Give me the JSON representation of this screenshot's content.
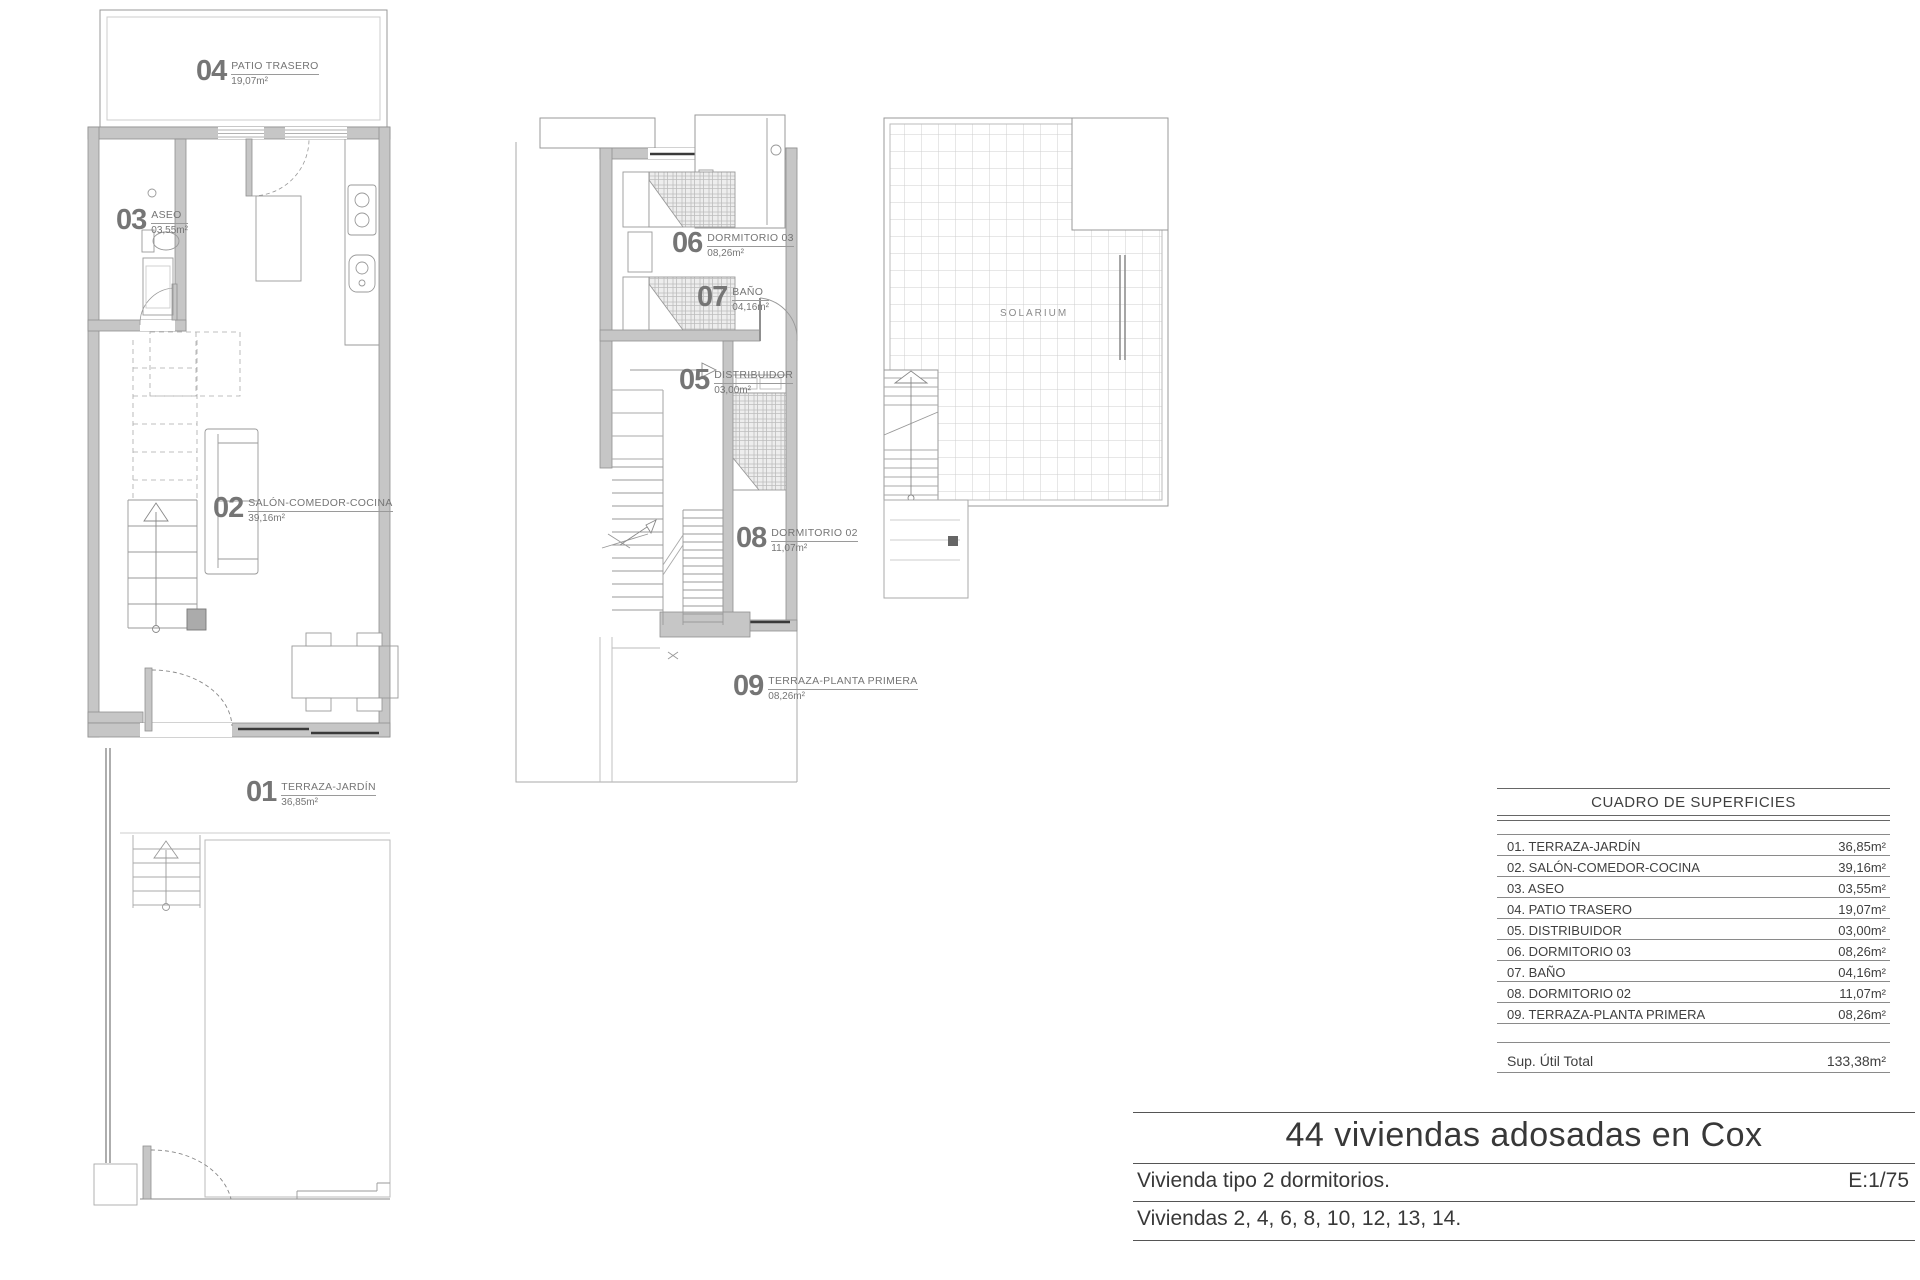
{
  "plans": {
    "ground": {
      "rooms": {
        "patio": {
          "num": "04",
          "name": "PATIO TRASERO",
          "area": "19,07m²"
        },
        "aseo": {
          "num": "03",
          "name": "ASEO",
          "area": "03,55m²"
        },
        "salon": {
          "num": "02",
          "name": "SALÓN-COMEDOR-COCINA",
          "area": "39,16m²"
        },
        "terraza": {
          "num": "01",
          "name": "TERRAZA-JARDÍN",
          "area": "36,85m²"
        }
      }
    },
    "first": {
      "rooms": {
        "dorm3": {
          "num": "06",
          "name": "DORMITORIO 03",
          "area": "08,26m²"
        },
        "bano": {
          "num": "07",
          "name": "BAÑO",
          "area": "04,16m²"
        },
        "distrib": {
          "num": "05",
          "name": "DISTRIBUIDOR",
          "area": "03,00m²"
        },
        "dorm2": {
          "num": "08",
          "name": "DORMITORIO 02",
          "area": "11,07m²"
        },
        "terraza": {
          "num": "09",
          "name": "TERRAZA-PLANTA PRIMERA",
          "area": "08,26m²"
        }
      }
    },
    "roof": {
      "solarium_label": "SOLARIUM"
    }
  },
  "surface_table": {
    "title": "CUADRO DE SUPERFICIES",
    "rows": [
      {
        "label": "01. TERRAZA-JARDÍN",
        "value": "36,85m²"
      },
      {
        "label": "02. SALÓN-COMEDOR-COCINA",
        "value": "39,16m²"
      },
      {
        "label": "03. ASEO",
        "value": "03,55m²"
      },
      {
        "label": "04. PATIO TRASERO",
        "value": "19,07m²"
      },
      {
        "label": "05. DISTRIBUIDOR",
        "value": "03,00m²"
      },
      {
        "label": "06. DORMITORIO 03",
        "value": "08,26m²"
      },
      {
        "label": "07. BAÑO",
        "value": "04,16m²"
      },
      {
        "label": "08. DORMITORIO 02",
        "value": "11,07m²"
      },
      {
        "label": "09. TERRAZA-PLANTA PRIMERA",
        "value": "08,26m²"
      }
    ],
    "total_label": "Sup. Útil Total",
    "total_value": "133,38m²"
  },
  "title_block": {
    "project": "44 viviendas adosadas en Cox",
    "type_line": "Vivienda tipo 2 dormitorios.",
    "scale": "E:1/75",
    "units_line": "Viviendas 2, 4, 6, 8, 10, 12, 13, 14."
  }
}
